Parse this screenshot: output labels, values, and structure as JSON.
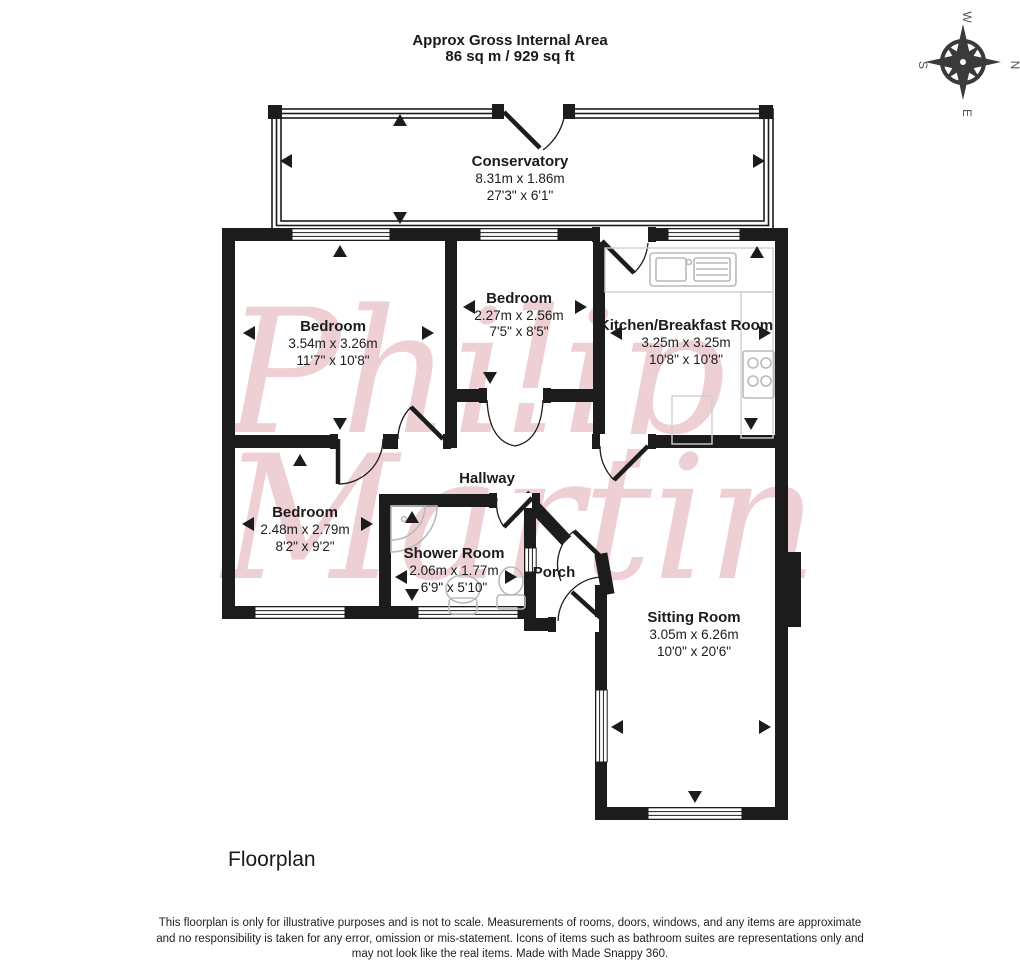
{
  "header": {
    "title_line1": "Approx Gross Internal Area",
    "title_line2": "86 sq m / 929 sq ft"
  },
  "compass": {
    "top": "W",
    "right": "N",
    "bottom": "E",
    "left": "S"
  },
  "rooms": [
    {
      "name": "Conservatory",
      "dims_m": "8.31m x 1.86m",
      "dims_ft": "27'3\" x 6'1\""
    },
    {
      "name": "Bedroom",
      "dims_m": "3.54m x 3.26m",
      "dims_ft": "11'7\" x 10'8\""
    },
    {
      "name": "Bedroom",
      "dims_m": "2.27m x 2.56m",
      "dims_ft": "7'5\" x 8'5\""
    },
    {
      "name": "Kitchen/Breakfast Room",
      "dims_m": "3.25m x 3.25m",
      "dims_ft": "10'8\" x 10'8\""
    },
    {
      "name": "Hallway"
    },
    {
      "name": "Bedroom",
      "dims_m": "2.48m x 2.79m",
      "dims_ft": "8'2\" x 9'2\""
    },
    {
      "name": "Shower Room",
      "dims_m": "2.06m x 1.77m",
      "dims_ft": "6'9\" x 5'10\""
    },
    {
      "name": "Porch"
    },
    {
      "name": "Sitting Room",
      "dims_m": "3.05m x 6.26m",
      "dims_ft": "10'0\" x 20'6\""
    }
  ],
  "watermark": {
    "line1": "Philip",
    "line2": "Martin"
  },
  "colors": {
    "wall": "#1c1c1c",
    "watermark": "#dfa3ab",
    "fixture": "#b9b9b9"
  },
  "footer": {
    "caption": "Floorplan",
    "disclaimer": "This floorplan is only for illustrative purposes and is not to scale. Measurements of rooms, doors, windows, and any items are approximate and no responsibility is taken for any error, omission or mis-statement. Icons of items such as bathroom suites are representations only and may not look like the real items. Made with Made Snappy 360."
  }
}
